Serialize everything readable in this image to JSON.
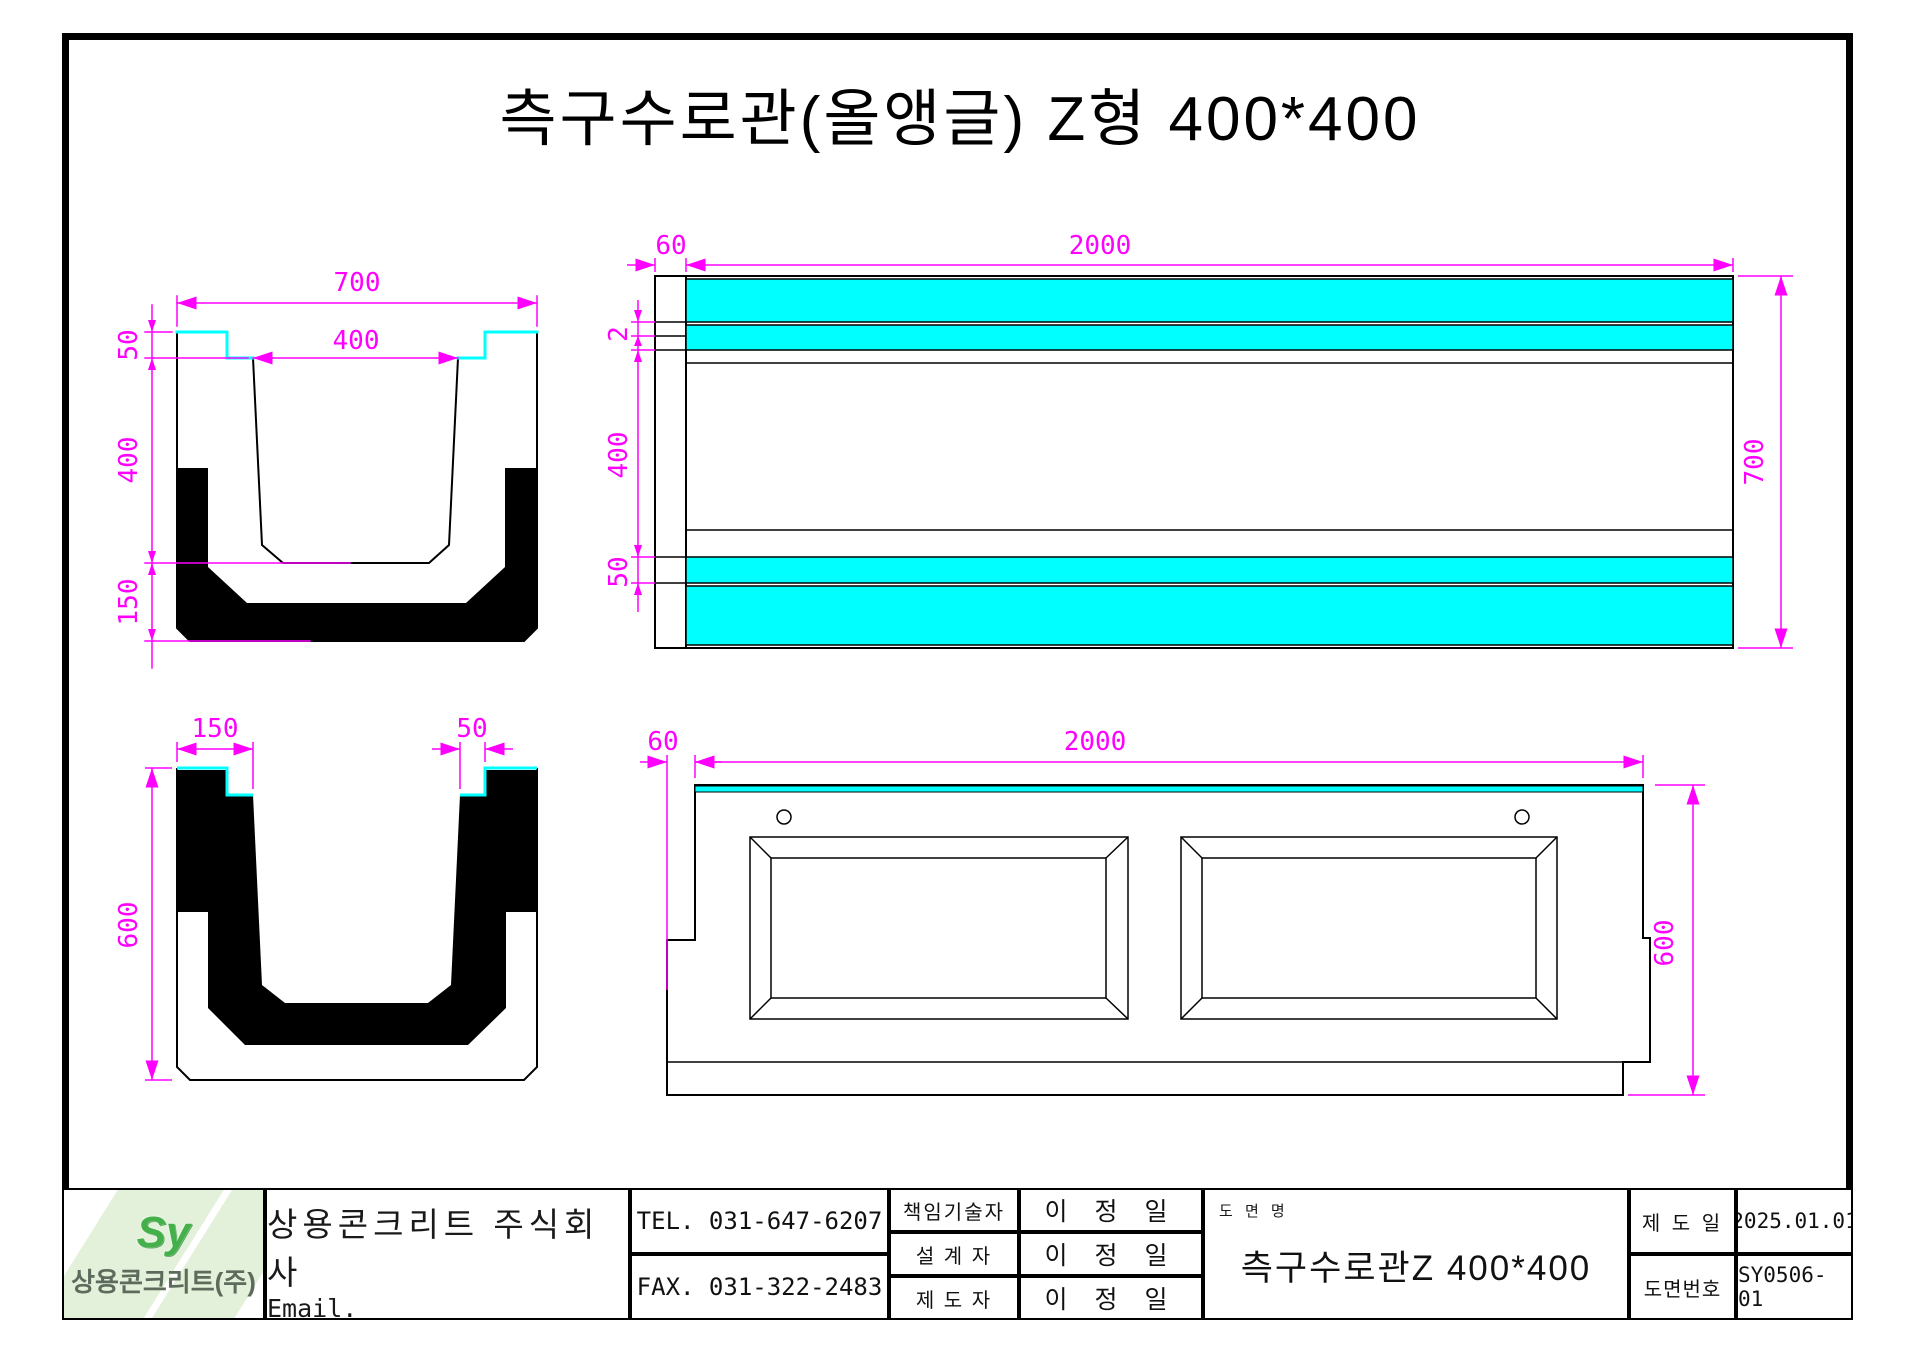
{
  "title": "측구수로관(올앵글) Z형  400*400",
  "colors": {
    "joint_cyan": "#00ffff",
    "dimension_magenta": "#ff00ff",
    "line_black": "#000000",
    "logo_green": "#43b049",
    "watermark_green": "#e3f1da"
  },
  "views": {
    "section": {
      "width": "700",
      "opening": "400",
      "lip": "50",
      "depth": "400",
      "base": "150"
    },
    "plan": {
      "end": "60",
      "length": "2000",
      "gap": "2",
      "middle": "400",
      "band": "50",
      "height": "700"
    },
    "end_view": {
      "wall": "150",
      "notch": "50",
      "height": "600"
    },
    "elevation": {
      "end": "60",
      "length": "2000",
      "height": "600"
    }
  },
  "title_block": {
    "logo": {
      "mark": "Sy",
      "company_short": "상용콘크리트(주)"
    },
    "company_name": "상용콘크리트 주식회사",
    "email": "Email. syct2409@naver.com",
    "tel": "TEL. 031-647-6207",
    "fax": "FAX. 031-322-2483",
    "rows": [
      {
        "role": "책임기술자",
        "name": "이 정 일"
      },
      {
        "role": "설 계 자",
        "name": "이 정 일"
      },
      {
        "role": "제 도 자",
        "name": "이 정 일"
      }
    ],
    "drawing_name_label": "도 면 명",
    "drawing_name": "측구수로관Z 400*400",
    "date_label": "제 도 일",
    "date_value": "2025.01.01",
    "number_label": "도면번호",
    "number_value": "SY0506-01"
  }
}
